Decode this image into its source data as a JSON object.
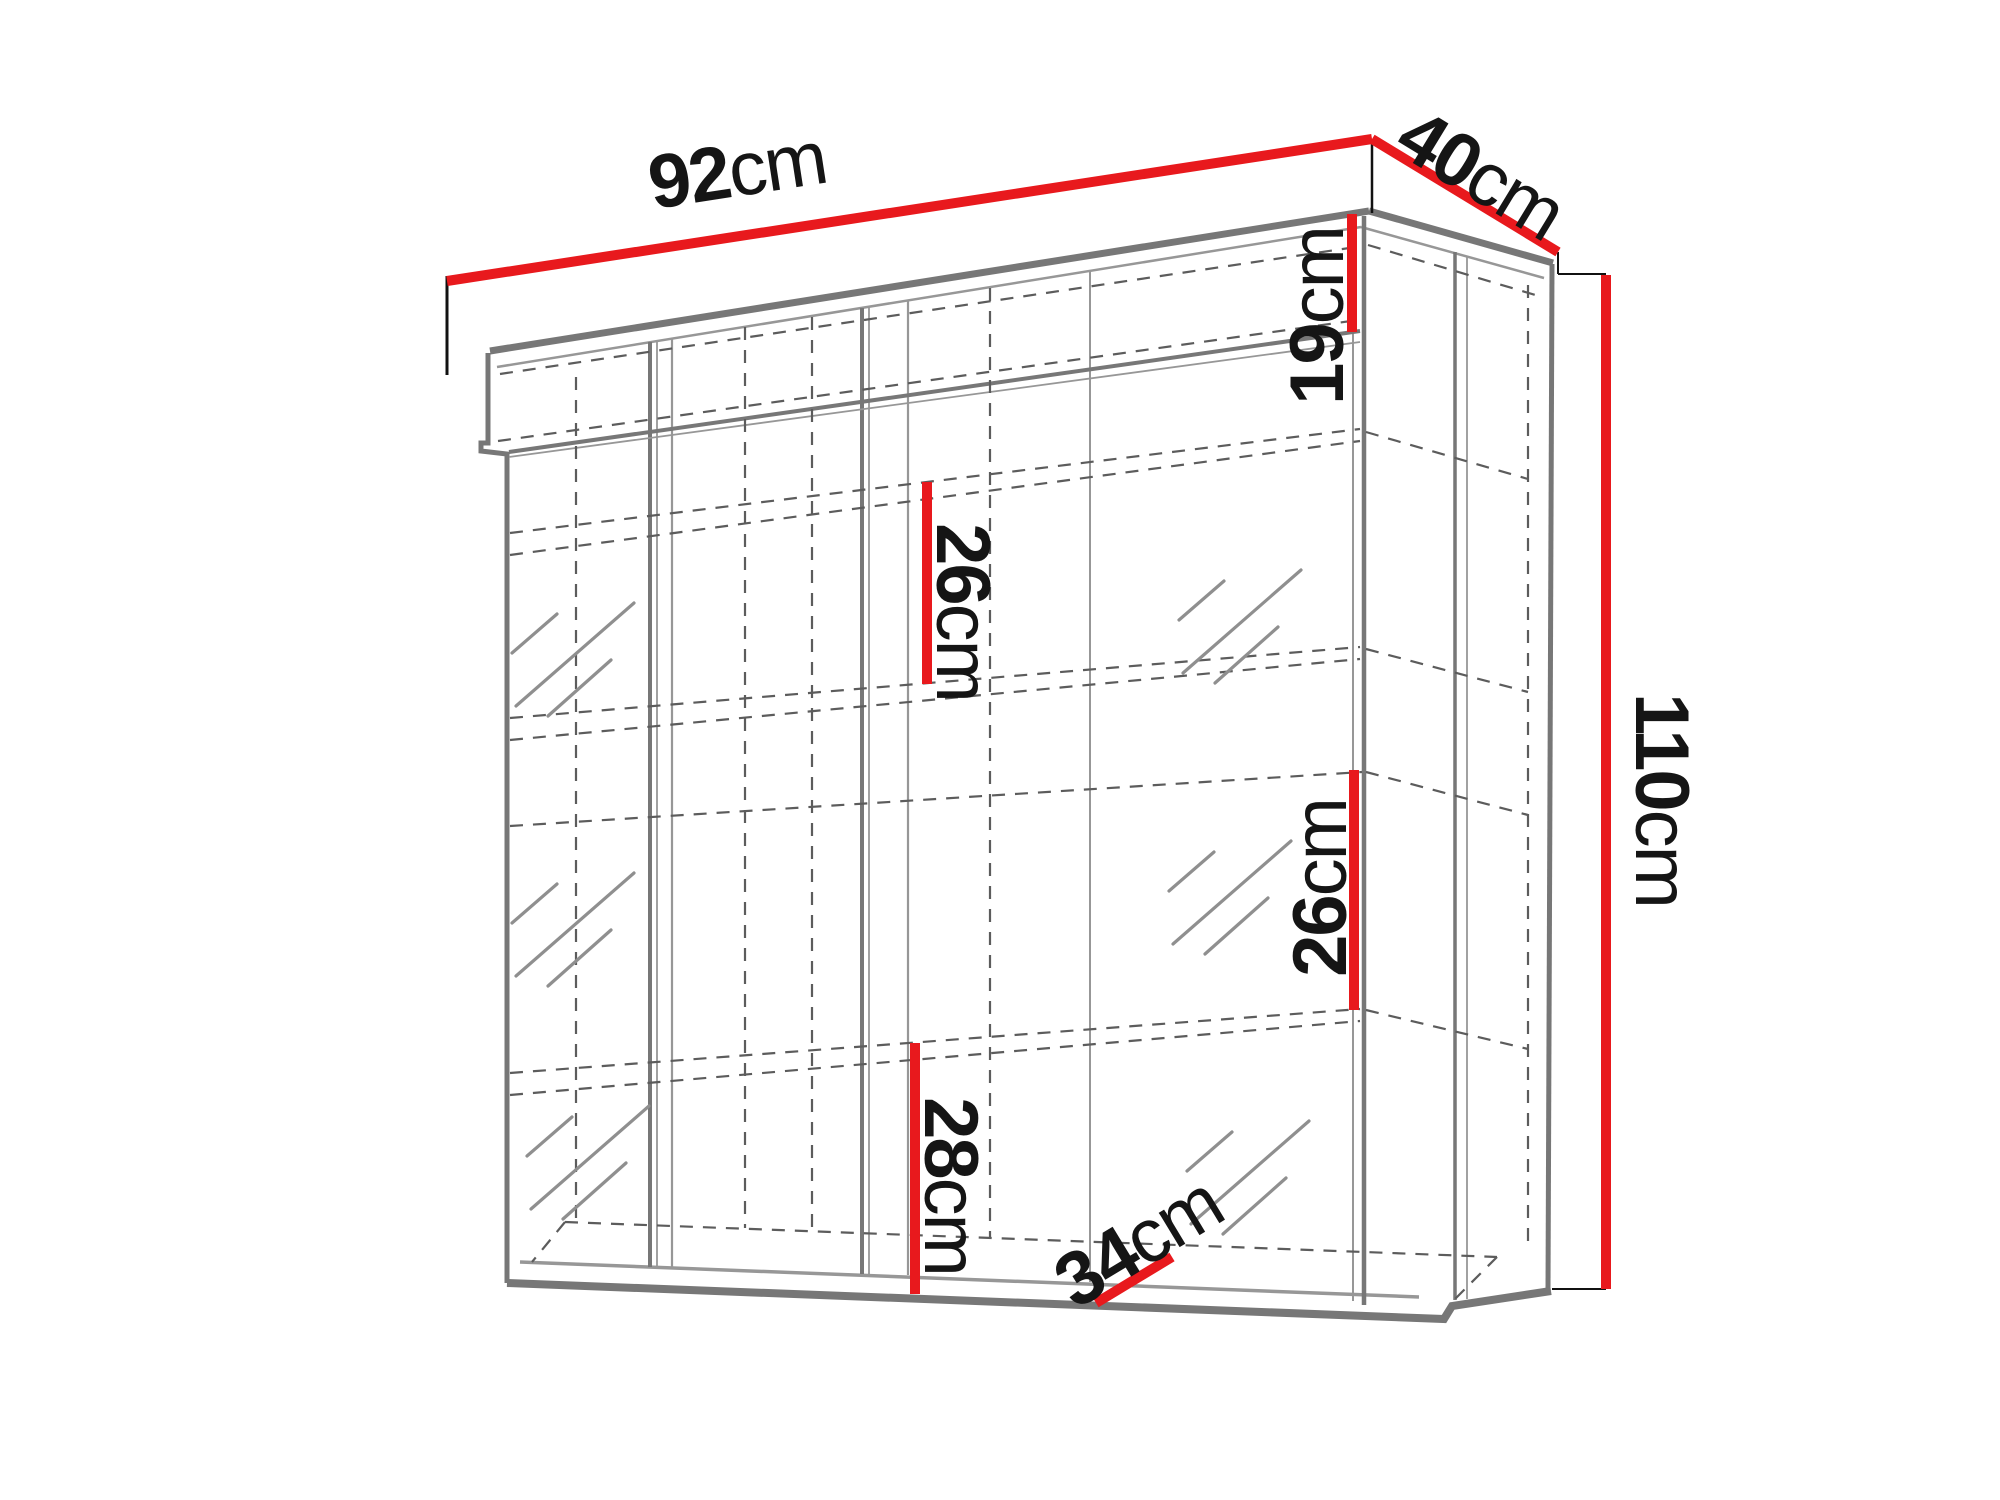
{
  "diagram": {
    "title": "Hanging display cabinet dimension drawing",
    "type": "furniture-wireframe-with-dimensions",
    "background_color": "#ffffff",
    "dimension_line_color": "#e8191d",
    "outline_color": "#777777",
    "hidden_line_color": "#5c5c5c",
    "text_color": "#151515"
  },
  "dims": {
    "width": {
      "value": "92",
      "unit": "cm"
    },
    "depth": {
      "value": "40",
      "unit": "cm"
    },
    "height": {
      "value": "110",
      "unit": "cm"
    },
    "top_compartment": {
      "value": "19",
      "unit": "cm"
    },
    "center_shelf": {
      "value": "26",
      "unit": "cm"
    },
    "right_shelf": {
      "value": "26",
      "unit": "cm"
    },
    "bottom_compartment": {
      "value": "28",
      "unit": "cm"
    },
    "interior_depth": {
      "value": "34",
      "unit": "cm"
    }
  }
}
